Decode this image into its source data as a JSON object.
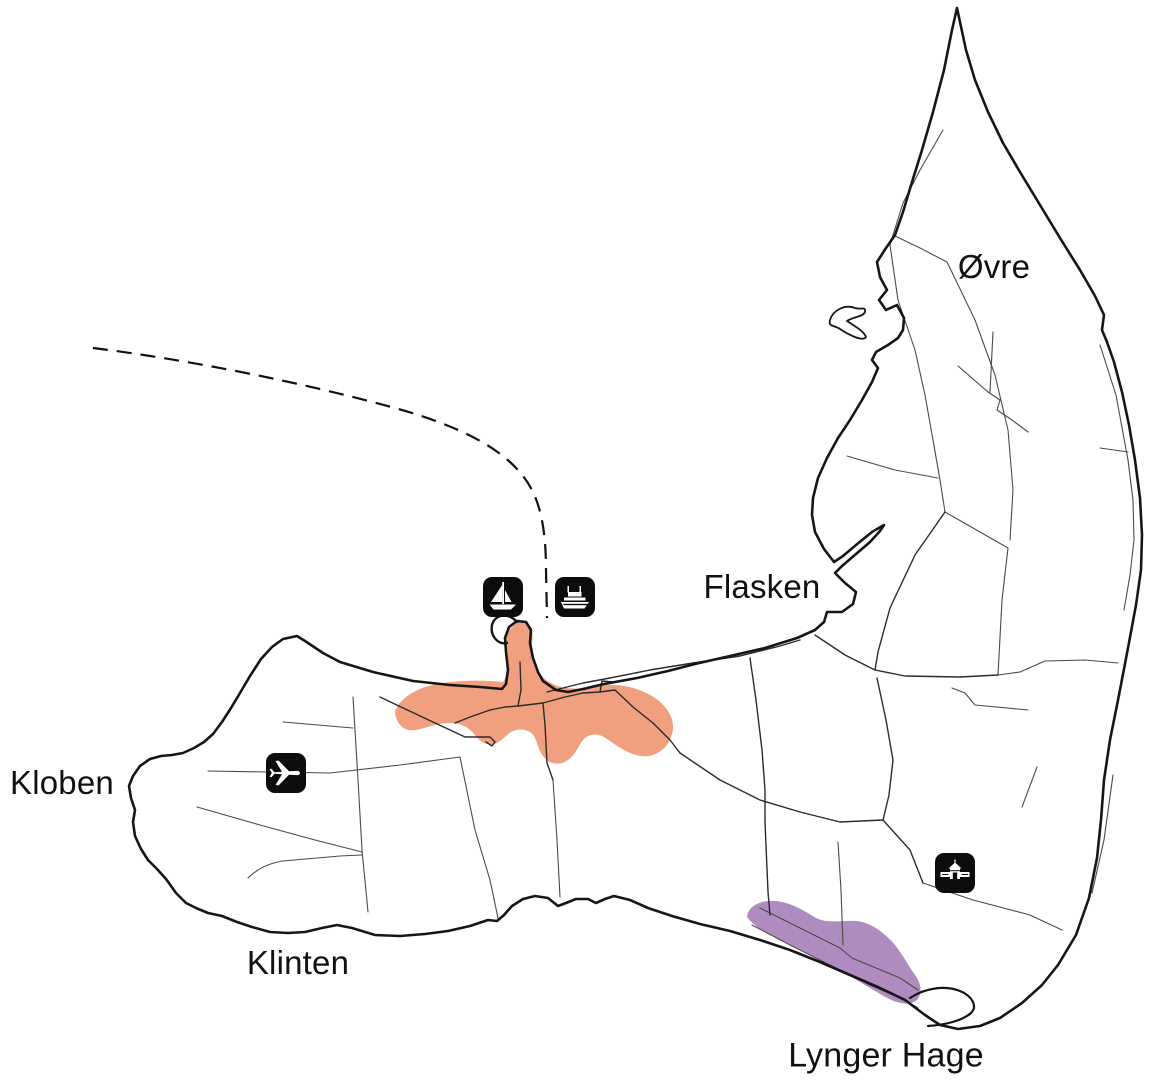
{
  "map": {
    "labels": [
      {
        "id": "ovre",
        "text": "Øvre"
      },
      {
        "id": "flasken",
        "text": "Flasken"
      },
      {
        "id": "kloben",
        "text": "Kloben"
      },
      {
        "id": "klinten",
        "text": "Klinten"
      },
      {
        "id": "lynger-hage",
        "text": "Lynger Hage"
      }
    ],
    "icons": [
      {
        "id": "sailboat",
        "meaning": "marina-sailing-harbour"
      },
      {
        "id": "ferry",
        "meaning": "ferry-terminal"
      },
      {
        "id": "airplane",
        "meaning": "airfield"
      },
      {
        "id": "museum",
        "meaning": "museum-building"
      }
    ],
    "route": {
      "id": "ferry-route",
      "style": "dashed"
    },
    "colors": {
      "background": "#ffffff",
      "coast": "#161616",
      "road_minor": "#4b4b4b",
      "road_main": "#2b2b2b",
      "town_area": "#F0A07E",
      "heath_area": "#AF8CBF",
      "route_line": "#111111",
      "icon_bg": "#0d0c0a",
      "icon_fg": "#ffffff"
    }
  }
}
